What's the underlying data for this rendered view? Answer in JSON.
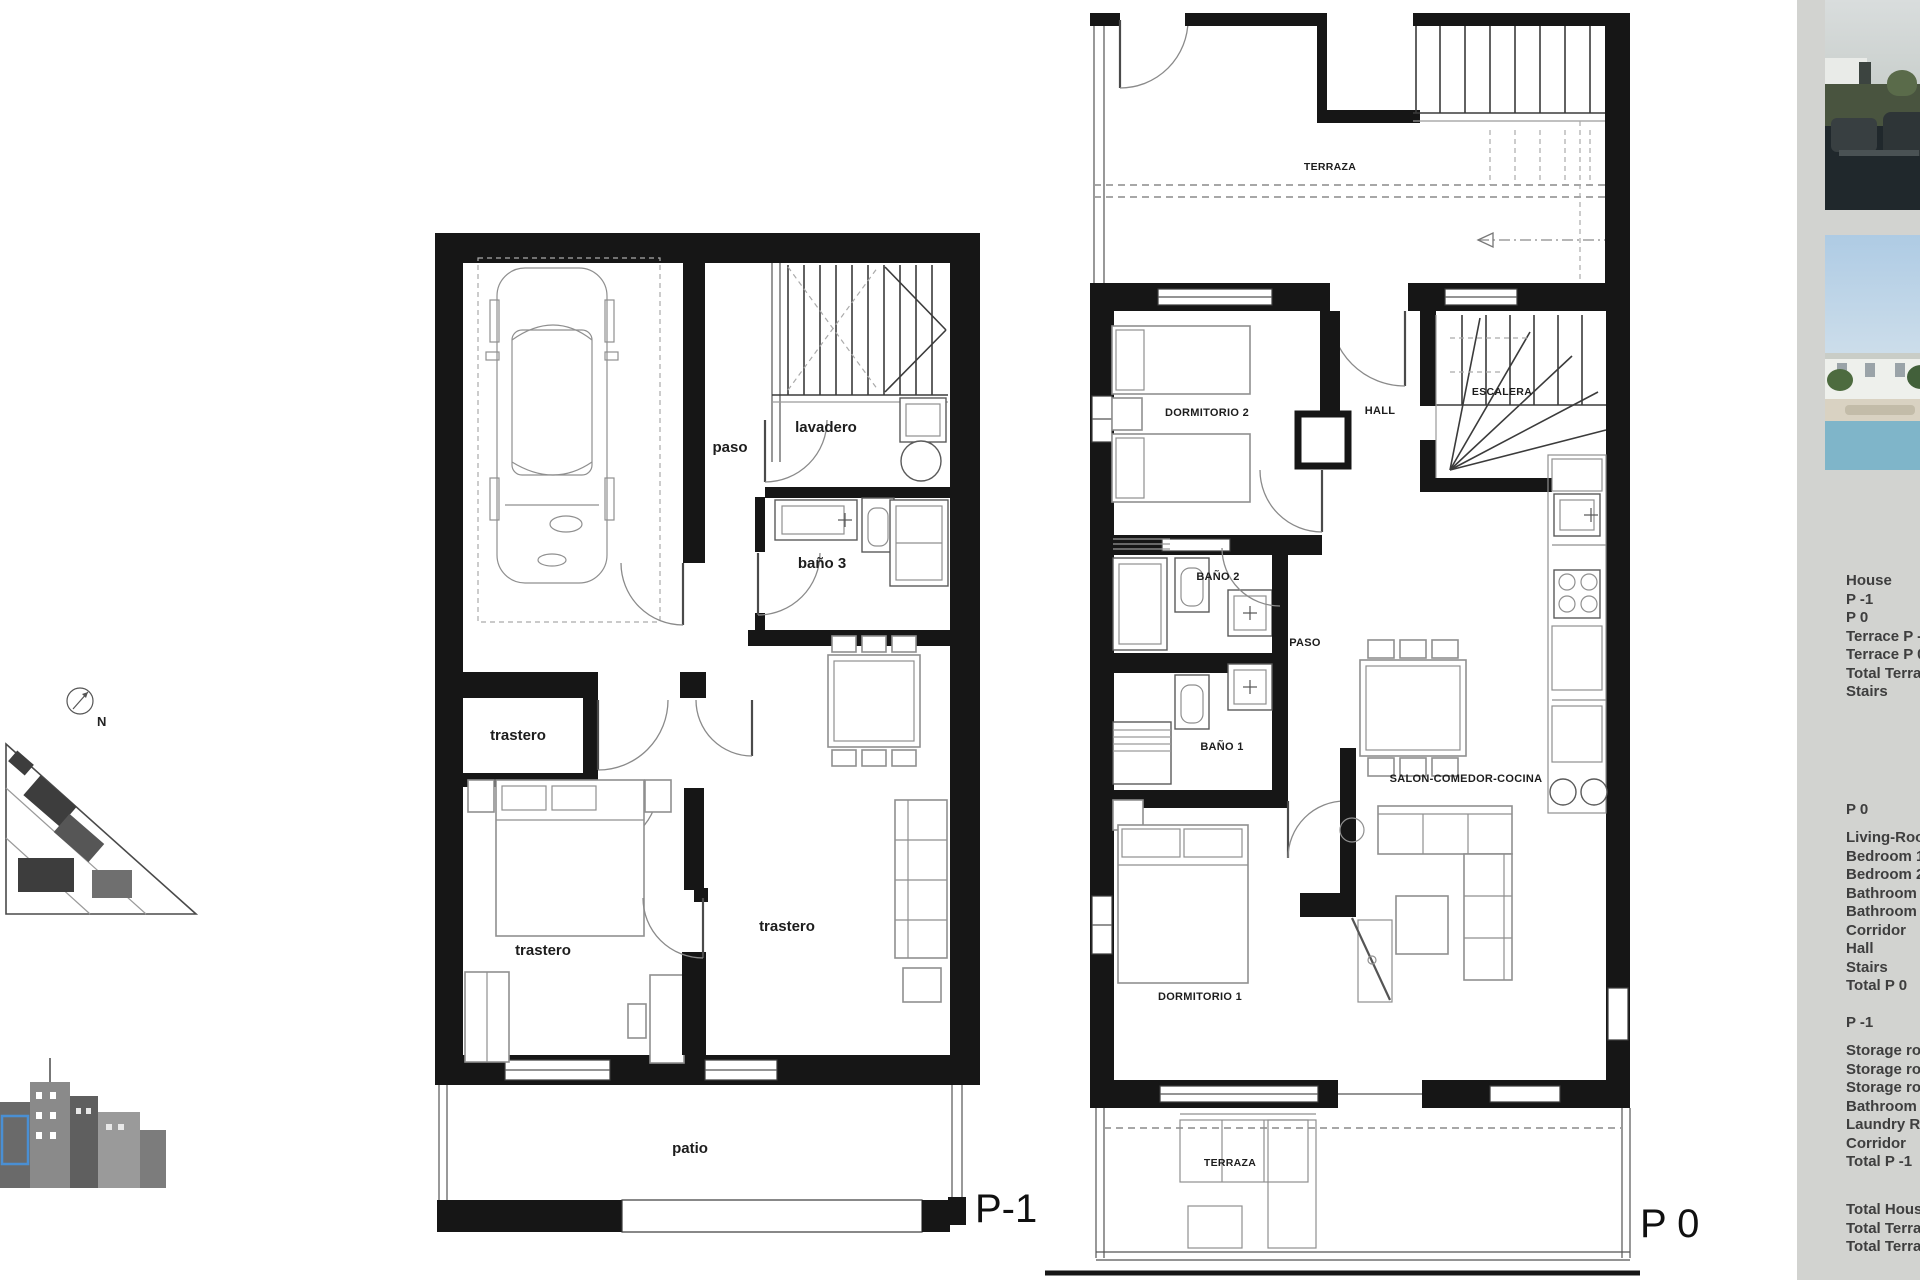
{
  "compass": {
    "north_label": "N"
  },
  "site_plan": {
    "highlight_color": "#4a8fd3"
  },
  "plans": {
    "p_minus_1": {
      "floor_label": "P-1",
      "room_labels": {
        "paso": "paso",
        "lavadero": "lavadero",
        "bano_3": "baño 3",
        "trastero_small": "trastero",
        "trastero_bedroom": "trastero",
        "trastero_living": "trastero",
        "patio": "patio"
      }
    },
    "p_0": {
      "floor_label": "P 0",
      "room_labels": {
        "terraza_top": "TERRAZA",
        "dormitorio_2": "DORMITORIO 2",
        "hall": "HALL",
        "escalera": "ESCALERA",
        "bano_2": "BAÑO 2",
        "paso": "PASO",
        "bano_1": "BAÑO 1",
        "salon_comedor_cocina": "SALON-COMEDOR-COCINA",
        "dormitorio_1": "DORMITORIO 1",
        "terraza_bottom": "TERRAZA"
      }
    }
  },
  "sidebar": {
    "background_color": "#d2d3d0",
    "photos": [
      {
        "name": "terrace-photo"
      },
      {
        "name": "pool-photo"
      }
    ],
    "summary": {
      "rows": [
        "House",
        "P -1",
        "P 0",
        "Terrace P -1",
        "Terrace P 0",
        "Total Terrace",
        "Stairs"
      ],
      "total_label": "TOTAL"
    },
    "p0_breakdown": {
      "title": "P 0",
      "rows": [
        "Living-Room",
        "Bedroom 1",
        "Bedroom 2",
        "Bathroom 1",
        "Bathroom 2",
        "Corridor",
        "Hall",
        "Stairs",
        "Total  P 0"
      ]
    },
    "p_minus_1_breakdown": {
      "title": "P -1",
      "rows": [
        "Storage room 1",
        "Storage room 2",
        "Storage room 3",
        "Bathroom 3",
        "Laundry Room",
        "Corridor",
        "Total  P -1"
      ]
    },
    "totals": {
      "rows": [
        "Total  House",
        "Total  Terrace",
        "Total  Terrace"
      ]
    }
  }
}
